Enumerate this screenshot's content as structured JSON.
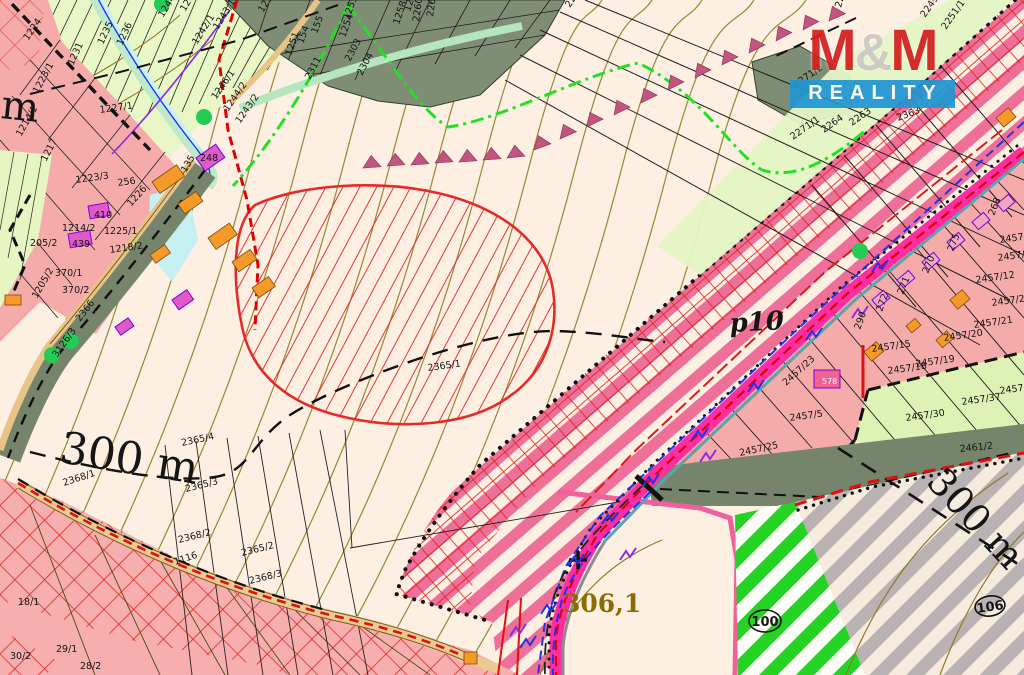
{
  "map": {
    "title_logo": {
      "name": "M&M",
      "amp": "&",
      "m1": "M",
      "m2": "M",
      "tagline": "REALITY"
    },
    "scale_labels": {
      "left": "300 m",
      "right": "300 m",
      "partial": "m"
    },
    "area_labels": {
      "p10": "p10",
      "plot": "306,1"
    },
    "circled": {
      "c100": "100",
      "c106": "106"
    },
    "colors": {
      "bg": "#fdf0e3",
      "urban_pink": "#f6abab",
      "field_green": "#e9f6c6",
      "forest": "#7f8d74",
      "corridor_stripe": "#ee6f97",
      "hatch_red": "#e62a2a",
      "road_magenta": "#ff2da2",
      "grey_stripe": "#b9b2b2",
      "green_stripe": "#25d325",
      "contour_olive": "#8d7b22",
      "water_cyan": "#c9f2f4",
      "label_olive": "#8a6d00",
      "logo_red": "#d3201f",
      "logo_blue": "#2196d3"
    },
    "parcel_labels": [
      {
        "t": "1224",
        "x": 28,
        "y": 41,
        "r": -55
      },
      {
        "t": "1223/1",
        "x": 38,
        "y": 94,
        "r": -62
      },
      {
        "t": "1227/1",
        "x": 100,
        "y": 113,
        "r": -8
      },
      {
        "t": "1214/1",
        "x": 21,
        "y": 137,
        "r": -60
      },
      {
        "t": "1217",
        "x": 46,
        "y": 162,
        "r": -62
      },
      {
        "t": "1223/3",
        "x": 76,
        "y": 183,
        "r": -8
      },
      {
        "t": "256",
        "x": 118,
        "y": 186,
        "r": -8
      },
      {
        "t": "1226",
        "x": 131,
        "y": 207,
        "r": -48
      },
      {
        "t": "135",
        "x": 186,
        "y": 173,
        "r": -60
      },
      {
        "t": "248",
        "x": 200,
        "y": 161,
        "r": 0
      },
      {
        "t": "410",
        "x": 94,
        "y": 218,
        "r": 0
      },
      {
        "t": "1214/2",
        "x": 62,
        "y": 231,
        "r": 0
      },
      {
        "t": "1225/1",
        "x": 104,
        "y": 234,
        "r": 0
      },
      {
        "t": "1218/2",
        "x": 110,
        "y": 253,
        "r": -8
      },
      {
        "t": "439",
        "x": 72,
        "y": 247,
        "r": 0
      },
      {
        "t": "205/2",
        "x": 30,
        "y": 246,
        "r": 0
      },
      {
        "t": "370/1",
        "x": 55,
        "y": 276,
        "r": 0
      },
      {
        "t": "370/2",
        "x": 62,
        "y": 293,
        "r": 0
      },
      {
        "t": "1205/2",
        "x": 37,
        "y": 299,
        "r": -60
      },
      {
        "t": "1235",
        "x": 103,
        "y": 45,
        "r": -65
      },
      {
        "t": "1236",
        "x": 122,
        "y": 46,
        "r": -65
      },
      {
        "t": "1231",
        "x": 73,
        "y": 66,
        "r": -65
      },
      {
        "t": "1244/1",
        "x": 163,
        "y": 18,
        "r": -58
      },
      {
        "t": "1241/1",
        "x": 185,
        "y": 12,
        "r": -58
      },
      {
        "t": "1242/1",
        "x": 197,
        "y": 45,
        "r": -58
      },
      {
        "t": "1250/1",
        "x": 263,
        "y": 13,
        "r": -58
      },
      {
        "t": "1243/1",
        "x": 218,
        "y": 30,
        "r": -58
      },
      {
        "t": "1246/1",
        "x": 216,
        "y": 100,
        "r": -55
      },
      {
        "t": "1244/2",
        "x": 228,
        "y": 112,
        "r": -55
      },
      {
        "t": "1243/2",
        "x": 240,
        "y": 124,
        "r": -55
      },
      {
        "t": "2303",
        "x": 350,
        "y": 62,
        "r": -62
      },
      {
        "t": "2304",
        "x": 362,
        "y": 76,
        "r": -62
      },
      {
        "t": "2311",
        "x": 310,
        "y": 80,
        "r": -62
      },
      {
        "t": "1251",
        "x": 291,
        "y": 56,
        "r": -70
      },
      {
        "t": "154",
        "x": 303,
        "y": 44,
        "r": -70
      },
      {
        "t": "155",
        "x": 317,
        "y": 34,
        "r": -70
      },
      {
        "t": "1254",
        "x": 345,
        "y": 38,
        "r": -70
      },
      {
        "t": "1255",
        "x": 349,
        "y": 20,
        "r": -70
      },
      {
        "t": "1258",
        "x": 399,
        "y": 25,
        "r": -72
      },
      {
        "t": "1259",
        "x": 410,
        "y": 12,
        "r": -72
      },
      {
        "t": "2260/2",
        "x": 419,
        "y": 22,
        "r": -82
      },
      {
        "t": "2260/1",
        "x": 433,
        "y": 17,
        "r": -82
      },
      {
        "t": "2294",
        "x": 570,
        "y": 8,
        "r": -58
      },
      {
        "t": "2366",
        "x": 80,
        "y": 322,
        "r": -52
      },
      {
        "t": "3126/3",
        "x": 57,
        "y": 358,
        "r": -55
      },
      {
        "t": "1116",
        "x": 175,
        "y": 565,
        "r": -18
      },
      {
        "t": "2365/1",
        "x": 428,
        "y": 371,
        "r": -8
      },
      {
        "t": "2365/4",
        "x": 182,
        "y": 446,
        "r": -12
      },
      {
        "t": "2368/1",
        "x": 64,
        "y": 486,
        "r": -18
      },
      {
        "t": "2365/3",
        "x": 186,
        "y": 492,
        "r": -14
      },
      {
        "t": "2368/2",
        "x": 179,
        "y": 543,
        "r": -14
      },
      {
        "t": "2365/2",
        "x": 242,
        "y": 556,
        "r": -14
      },
      {
        "t": "2368/3",
        "x": 250,
        "y": 584,
        "r": -14
      },
      {
        "t": "18/1",
        "x": 18,
        "y": 605,
        "r": 0
      },
      {
        "t": "30/2",
        "x": 10,
        "y": 659,
        "r": 0
      },
      {
        "t": "29/1",
        "x": 56,
        "y": 652,
        "r": 0
      },
      {
        "t": "28/2",
        "x": 80,
        "y": 669,
        "r": 0
      },
      {
        "t": "2271/2",
        "x": 796,
        "y": 88,
        "r": -35
      },
      {
        "t": "2271/1",
        "x": 793,
        "y": 140,
        "r": -35
      },
      {
        "t": "2264",
        "x": 824,
        "y": 133,
        "r": -35
      },
      {
        "t": "2263",
        "x": 852,
        "y": 126,
        "r": -35
      },
      {
        "t": "2363",
        "x": 898,
        "y": 121,
        "r": -20
      },
      {
        "t": "2249/3",
        "x": 925,
        "y": 18,
        "r": -55
      },
      {
        "t": "2251/1",
        "x": 946,
        "y": 30,
        "r": -55
      },
      {
        "t": "2253",
        "x": 841,
        "y": 8,
        "r": -75
      },
      {
        "t": "290",
        "x": 860,
        "y": 330,
        "r": -70
      },
      {
        "t": "272",
        "x": 882,
        "y": 312,
        "r": -70
      },
      {
        "t": "271",
        "x": 903,
        "y": 295,
        "r": -68
      },
      {
        "t": "270",
        "x": 928,
        "y": 274,
        "r": -68
      },
      {
        "t": "275",
        "x": 953,
        "y": 252,
        "r": -68
      },
      {
        "t": "268",
        "x": 994,
        "y": 216,
        "r": -68
      },
      {
        "t": "578",
        "x": 822,
        "y": 384,
        "r": 0,
        "c": "wh"
      },
      {
        "t": "2457/25",
        "x": 740,
        "y": 456,
        "r": -12
      },
      {
        "t": "2457/5",
        "x": 790,
        "y": 421,
        "r": -8
      },
      {
        "t": "2457/23",
        "x": 786,
        "y": 386,
        "r": -42
      },
      {
        "t": "2457/15",
        "x": 872,
        "y": 352,
        "r": -8
      },
      {
        "t": "2457/18",
        "x": 888,
        "y": 374,
        "r": -8
      },
      {
        "t": "2457/19",
        "x": 916,
        "y": 367,
        "r": -8
      },
      {
        "t": "2457/20",
        "x": 944,
        "y": 341,
        "r": -8
      },
      {
        "t": "2457/21",
        "x": 974,
        "y": 328,
        "r": -8
      },
      {
        "t": "2457/22",
        "x": 992,
        "y": 306,
        "r": -8
      },
      {
        "t": "2457/2",
        "x": 1000,
        "y": 243,
        "r": -8
      },
      {
        "t": "2457/11",
        "x": 998,
        "y": 261,
        "r": -8
      },
      {
        "t": "2457/12",
        "x": 976,
        "y": 283,
        "r": -8
      },
      {
        "t": "2457/30",
        "x": 906,
        "y": 421,
        "r": -8
      },
      {
        "t": "2457/37",
        "x": 962,
        "y": 405,
        "r": -8
      },
      {
        "t": "2457/3",
        "x": 1000,
        "y": 394,
        "r": -8
      },
      {
        "t": "2461/2",
        "x": 960,
        "y": 452,
        "r": -6
      }
    ],
    "tree_dots": [
      [
        162,
        4
      ],
      [
        204,
        117
      ],
      [
        71,
        341
      ],
      [
        52,
        355
      ],
      [
        860,
        251
      ]
    ],
    "slope_triangles": [
      [
        372,
        168,
        -4
      ],
      [
        396,
        166,
        -4
      ],
      [
        420,
        165,
        -4
      ],
      [
        444,
        163,
        -4
      ],
      [
        468,
        162,
        -4
      ],
      [
        492,
        160,
        -4
      ],
      [
        516,
        158,
        -6
      ],
      [
        543,
        150,
        -20
      ],
      [
        569,
        139,
        -24
      ],
      [
        596,
        127,
        -26
      ],
      [
        623,
        115,
        -26
      ],
      [
        650,
        103,
        -26
      ],
      [
        677,
        90,
        -27
      ],
      [
        704,
        78,
        -27
      ],
      [
        731,
        65,
        -27
      ],
      [
        758,
        53,
        -27
      ],
      [
        785,
        41,
        -28
      ],
      [
        812,
        30,
        -28
      ],
      [
        838,
        21,
        -24
      ]
    ],
    "utility_zigzags_blue": [
      [
        872,
        272
      ],
      [
        806,
        340
      ],
      [
        748,
        392
      ],
      [
        692,
        440
      ],
      [
        643,
        486
      ],
      [
        602,
        524
      ],
      [
        568,
        566
      ],
      [
        541,
        614
      ],
      [
        520,
        648
      ]
    ],
    "utility_zigzags_violet": [
      [
        852,
        318
      ],
      [
        700,
        462
      ],
      [
        620,
        560
      ],
      [
        510,
        636
      ]
    ]
  }
}
